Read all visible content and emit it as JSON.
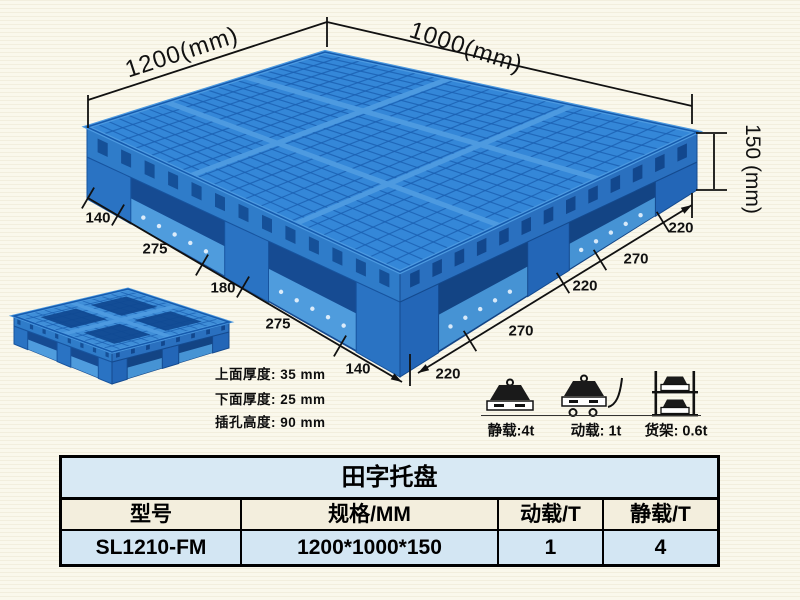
{
  "scene": {
    "dim_length": "1200(mm)",
    "dim_width": "1000(mm)",
    "dim_height": "150 (mm)",
    "left_segments": [
      "140",
      "275",
      "180",
      "275",
      "140"
    ],
    "right_segments": [
      "220",
      "270",
      "220",
      "270",
      "220"
    ],
    "specs": [
      "上面厚度: 35 mm",
      "下面厚度: 25 mm",
      "插孔高度: 90 mm"
    ],
    "load_labels": [
      "静载:4t",
      "动载: 1t",
      "货架: 0.6t"
    ]
  },
  "table": {
    "title": "田字托盘",
    "headers": [
      "型号",
      "规格/MM",
      "动载/T",
      "静载/T"
    ],
    "rows": [
      [
        "SL1210-FM",
        "1200*1000*150",
        "1",
        "4"
      ]
    ]
  },
  "colors": {
    "pallet_blue": "#3487d8",
    "pallet_dark_blue": "#1b60b2",
    "pallet_light_rib": "#4d9ae0",
    "table_blue_row": "#d3e6f3",
    "table_cream_row": "#f3eedd",
    "background": "#faf8ec"
  }
}
